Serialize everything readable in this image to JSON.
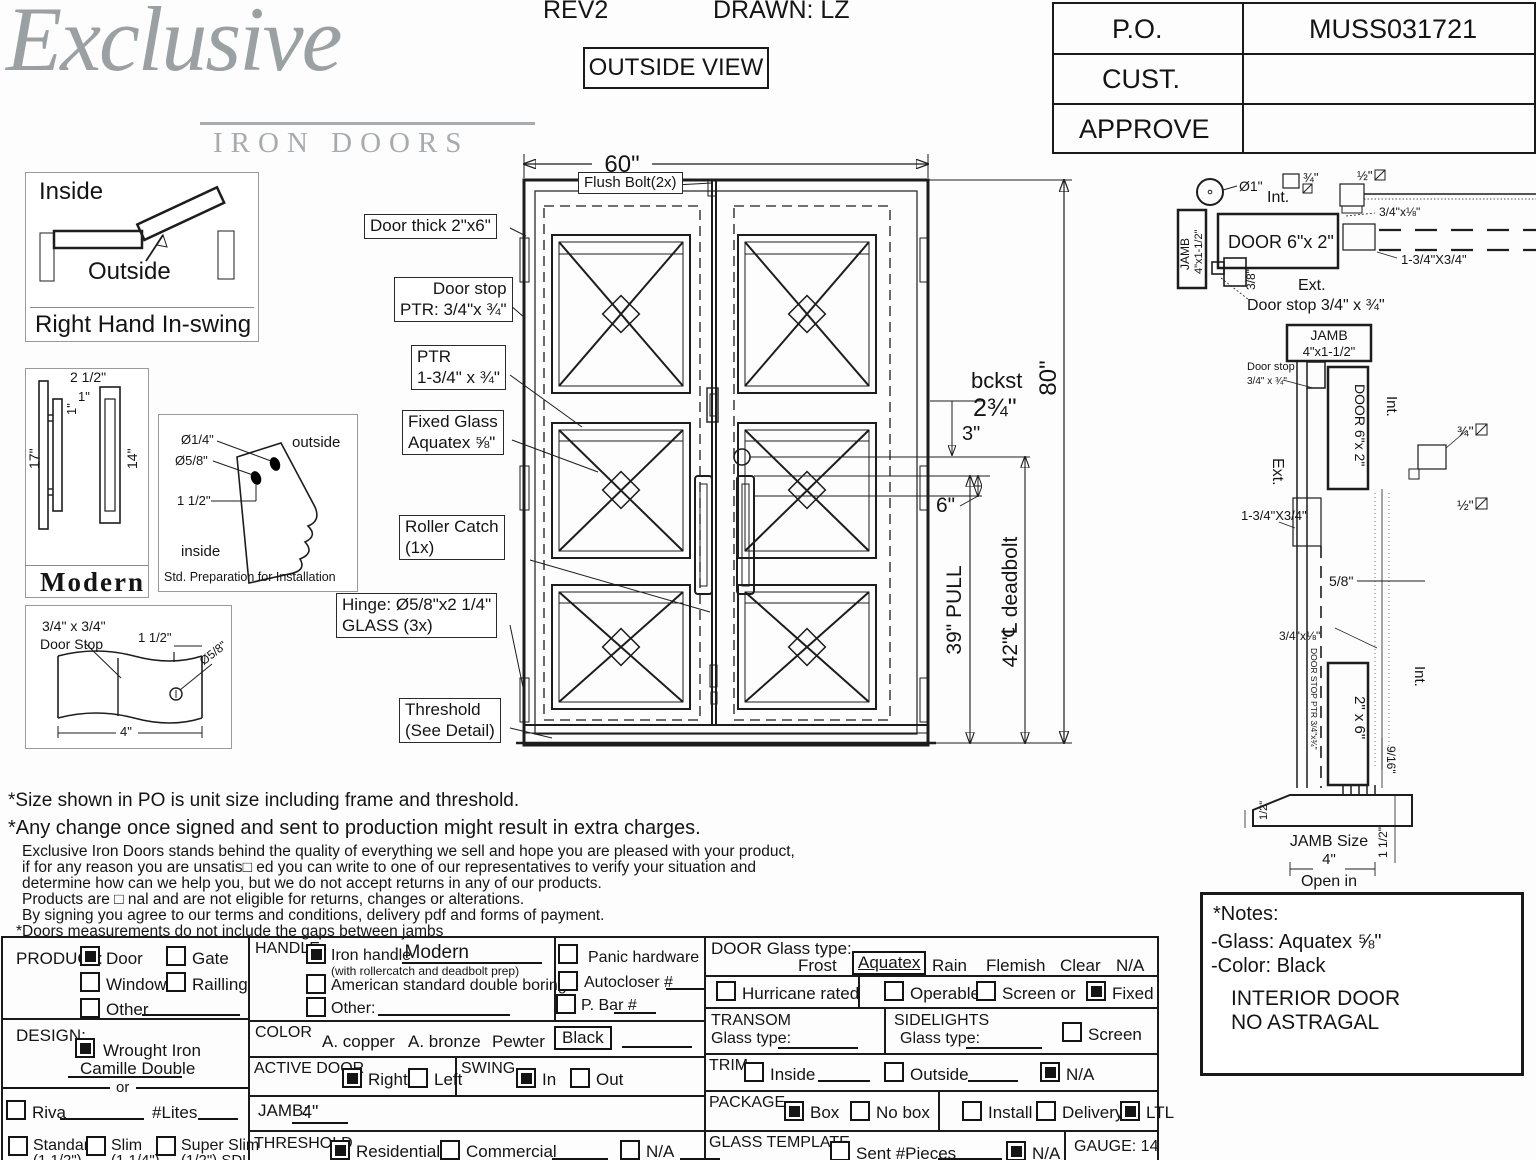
{
  "header": {
    "rev": "REV2",
    "drawn": "DRAWN: LZ",
    "view": "OUTSIDE VIEW"
  },
  "logo": {
    "name": "Exclusive",
    "sub": "IRON DOORS"
  },
  "po_table": {
    "r1": "P.O.",
    "v1": "MUSS031721",
    "r2": "CUST.",
    "v2": "",
    "r3": "APPROVE",
    "v3": ""
  },
  "swing": {
    "inside": "Inside",
    "outside": "Outside",
    "caption": "Right Hand In-swing"
  },
  "modern": {
    "d1": "2 1/2\"",
    "d2": "1\"",
    "d3": "1\"",
    "d4": "17\"",
    "d5": "14\"",
    "caption": "Modern"
  },
  "prep": {
    "d1": "Ø1/4\"",
    "d2": "Ø5/8\"",
    "d3": "1 1/2\"",
    "outside": "outside",
    "inside": "inside",
    "caption": "Std. Preparation for Installation"
  },
  "stopdet": {
    "l1": "3/4\" x 3/4\"",
    "l2": "Door Stop",
    "d1": "1 1/2\"",
    "d2": "Ø5/8\"",
    "d3": "4\""
  },
  "drawing": {
    "w": "60\"",
    "h": "80\"",
    "flush": "Flush Bolt(2x)",
    "thick": "Door thick 2\"x6\"",
    "stop1": "Door stop",
    "stop2": "PTR: 3/4\"x ¾\"",
    "ptr1": "PTR",
    "ptr2": "1-3/4\" x ¾\"",
    "glass1": "Fixed Glass",
    "glass2": "Aquatex ⅝\"",
    "roller1": "Roller Catch",
    "roller2": "(1x)",
    "hinge1": "Hinge: Ø5/8\"x2 1/4\"",
    "hinge2": "GLASS (3x)",
    "thresh1": "Threshold",
    "thresh2": "(See Detail)",
    "bckst": "bckst",
    "bckst_val": "2¾\"",
    "d3": "3\"",
    "d6": "6\"",
    "pull": "39\" PULL",
    "deadbolt": "42\"℄ deadbolt"
  },
  "sec_top": {
    "dia": "Ø1\"",
    "int": "Int.",
    "ext": "Ext.",
    "jamb": "JAMB",
    "jamb_size": "4\"x1-1/2\"",
    "door": "DOOR 6\"x 2\"",
    "sq34": "¾\"",
    "sq12": "½\"",
    "a": "3/4\"x⅛\"",
    "b": "1-3/4\"X3/4\"",
    "c": "3/8\"",
    "stop": "Door stop 3/4\" x ¾\""
  },
  "sec_side": {
    "jamb": "JAMB",
    "jamb_size": "4\"x1-1/2\"",
    "stop1": "Door stop",
    "stop2": "3/4\" x ¾\"",
    "ext": "Ext.",
    "int": "Int.",
    "int2": "Int.",
    "door": "DOOR 6\"x 2\"",
    "door2": "2\" x 6\"",
    "sq34": "¾\"",
    "sq12": "½\"",
    "a": "1-3/4\"X3/4\"",
    "b": "3/4\"x⅛\"",
    "c": "5/8\"",
    "stop_ptr": "DOOR STOP PTR 3/4\"x¾\"",
    "d916": "9/16\"",
    "d12": "1/2\"",
    "d112": "1 1/2\"",
    "js1": "JAMB Size",
    "js2": "4\"",
    "js3": "Open in"
  },
  "notes": {
    "title": "*Notes:",
    "glass": "-Glass: Aquatex ⅝\"",
    "color": "-Color: Black",
    "l1": "INTERIOR DOOR",
    "l2": "NO ASTRAGAL"
  },
  "disclaimer": {
    "d1": "*Size shown in PO is unit size including frame and threshold.",
    "d2": "*Any change once signed and sent to production might result in extra charges.",
    "body": [
      "Exclusive Iron Doors stands behind the quality of everything we sell and hope you are pleased with your product,",
      "if for any reason you are unsatis□ ed you can write to one of our representatives to verify your situation and",
      "determine how can we help you, but we do not accept returns in any of our products.",
      "Products are □ nal and are not eligible for returns, changes or alterations.",
      "By signing you agree to our terms and conditions, delivery pdf and forms of payment.",
      "*Doors measurements do not include the gaps between jambs"
    ]
  },
  "form": {
    "product": {
      "label": "PRODUCT:",
      "door": "Door",
      "gate": "Gate",
      "window": "Window",
      "railling": "Railling",
      "other": "Other",
      "door_checked": true,
      "gate_checked": false,
      "window_checked": false,
      "railling_checked": false,
      "other_checked": false
    },
    "design": {
      "label": "DESIGN:",
      "wrought": "Wrought Iron",
      "wrought_checked": true,
      "model": "Camille Double",
      "or": "or",
      "riva": "Riva",
      "riva_checked": false,
      "lites": "#Lites",
      "standard": "Standard",
      "standard_sub": "(1 1/2\")",
      "standard_checked": false,
      "slim": "Slim",
      "slim_sub": "(1 1/4\")",
      "slim_checked": false,
      "superslim": "Super Slim",
      "superslim_sub": "(1/2\") SDL",
      "superslim_checked": false
    },
    "handle": {
      "label": "HANDLE",
      "iron": "Iron handle",
      "iron_value": ": Modern",
      "iron_note": "(with rollercatch and deadbolt prep)",
      "iron_checked": true,
      "american": "American standard double boring",
      "american_checked": false,
      "other": "Other:",
      "other_checked": false
    },
    "hardware": {
      "panic": "Panic hardware",
      "panic_checked": false,
      "autocloser": "Autocloser #",
      "autocloser_checked": false,
      "pbar": "P. Bar #",
      "pbar_checked": false
    },
    "color": {
      "label": "COLOR",
      "copper": "A. copper",
      "bronze": "A. bronze",
      "pewter": "Pewter",
      "black": "Black"
    },
    "active": {
      "label": "ACTIVE DOOR",
      "right": "Right",
      "right_checked": true,
      "left": "Left",
      "left_checked": false
    },
    "swing": {
      "label": "SWING",
      "in": "In",
      "in_checked": true,
      "out": "Out",
      "out_checked": false
    },
    "jamb": {
      "label": "JAMB:",
      "value": "4\""
    },
    "threshold": {
      "label": "THRESHOLD",
      "residential": "Residential",
      "residential_checked": true,
      "commercial": "Commercial",
      "commercial_checked": false,
      "na": "N/A",
      "na_checked": false
    },
    "glass": {
      "label": "DOOR Glass type:",
      "frost": "Frost",
      "aquatex": "Aquatex",
      "rain": "Rain",
      "flemish": "Flemish",
      "clear": "Clear",
      "na": "N/A"
    },
    "glass2": {
      "hurricane": "Hurricane rated",
      "hurricane_checked": false,
      "operable": "Operable",
      "operable_checked": false,
      "screen": "Screen or",
      "screen_checked": false,
      "fixed": "Fixed",
      "fixed_checked": true
    },
    "transom": {
      "label": "TRANSOM",
      "glass": "Glass type:"
    },
    "sidelights": {
      "label": "SIDELIGHTS",
      "glass": "Glass type:",
      "screen": "Screen",
      "screen_checked": false
    },
    "trim": {
      "label": "TRIM",
      "inside": "Inside",
      "inside_checked": false,
      "outside": "Outside",
      "outside_checked": false,
      "na": "N/A",
      "na_checked": true
    },
    "pkg": {
      "label": "PACKAGE",
      "box": "Box",
      "box_checked": true,
      "nobox": "No box",
      "nobox_checked": false,
      "install": "Install",
      "install_checked": false,
      "delivery": "Delivery",
      "delivery_checked": false,
      "ltl": "LTL",
      "ltl_checked": true
    },
    "gt": {
      "label": "GLASS TEMPLATE",
      "sent": "Sent #Pieces",
      "sent_checked": false,
      "na": "N/A",
      "na_checked": true
    },
    "gauge": "GAUGE: 14"
  }
}
